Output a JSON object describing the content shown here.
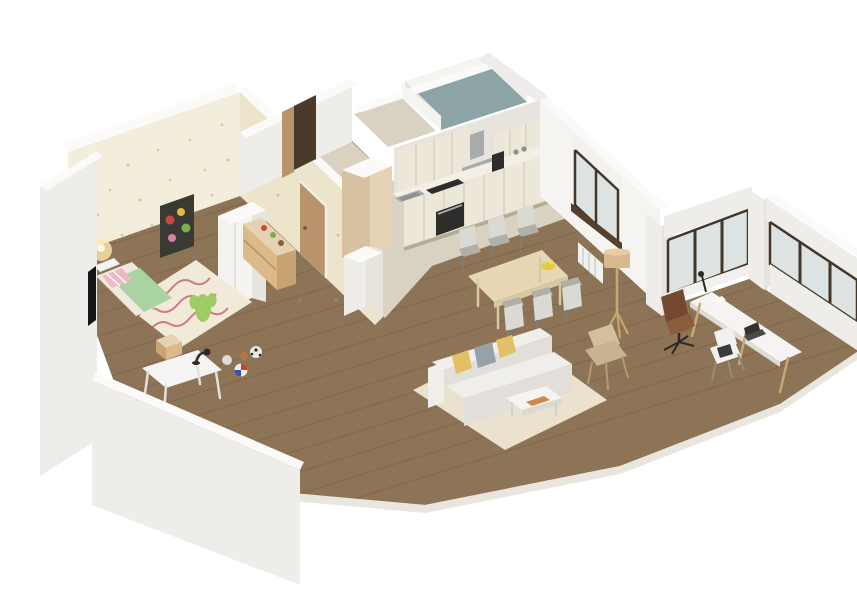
{
  "title": "isometric-3d-apartment-floor-plan-render",
  "view": {
    "type": "isometric-cutaway-render",
    "background": "#ffffff",
    "no_visible_text": true
  },
  "rooms": [
    {
      "id": "kids-bedroom",
      "floor": "wood",
      "walls": "patterned-wallpaper",
      "furniture": [
        "bed",
        "wavy-rug",
        "toy-cactus",
        "white-desk",
        "desk-lamp",
        "stool",
        "balls",
        "wardrobe",
        "dresser",
        "poster",
        "wall-lamp",
        "door"
      ]
    },
    {
      "id": "hallway",
      "floor": "tile",
      "furniture": [
        "back-door"
      ]
    },
    {
      "id": "bathroom",
      "floor": "teal"
    },
    {
      "id": "closet-nook",
      "floor": "tile"
    },
    {
      "id": "kitchen",
      "floor": "tile",
      "furniture": [
        "upper-cabinets",
        "range-hood",
        "cooktop",
        "oven",
        "sink",
        "coffee-maker",
        "tall-cabinet",
        "peninsula-pillar"
      ]
    },
    {
      "id": "dining-area",
      "floor": "wood",
      "furniture": [
        "dining-table",
        "six-chairs",
        "fruit-bowl",
        "window",
        "radiator"
      ]
    },
    {
      "id": "living-room",
      "floor": "wood",
      "furniture": [
        "sofa",
        "pillows",
        "coffee-table",
        "area-rug",
        "tripod-floor-lamp",
        "shell-chair"
      ]
    },
    {
      "id": "office-nook",
      "floor": "wood",
      "furniture": [
        "long-desk",
        "laptop",
        "desk-lamp",
        "leather-office-chair",
        "white-side-chair",
        "corner-windows"
      ]
    }
  ],
  "colors": {
    "bg": "#ffffff",
    "wood": "#8d7457",
    "tile": "#d9d1c2",
    "bath": "#8da4a6",
    "wallWhite": "#efedea",
    "wallLit": "#f5f4f1",
    "wallShade": "#e7e4de",
    "wallTop": "#fbfaf8",
    "wallpaper": "#f3eedb",
    "wallpaperEdge": "#ece5cc",
    "wallpaperDot": "#b3ab83",
    "posterBg": "#3a3a34",
    "doorWood": "#b9936b",
    "doorDark": "#4a3a2c",
    "wardrobe": "#f4f3f0",
    "wardrobeSide": "#e6e4df",
    "dresser": "#dcb988",
    "dresserSide": "#c9a371",
    "bedFrame": "#efe9dd",
    "bedGreen": "#a9d3a2",
    "bedPink": "#f0b7c4",
    "kidsRug": "#f2ead8",
    "rugLine": "#c2586b",
    "deskWhite": "#f5f4f2",
    "lampBlack": "#2b2a28",
    "cabinet": "#ece7d9",
    "cabinetShade": "#ddd6c4",
    "counter": "#f3efe4",
    "tallTan": "#d8c1a0",
    "tallTanLit": "#e5d2b4",
    "steel": "#a7abac",
    "applianceDark": "#2e2d2b",
    "table": "#e8d7b4",
    "tableLeg": "#d9c79f",
    "chairShell": "#b0b0a8",
    "chairLight": "#dadad5",
    "bowlYellow": "#e9c93f",
    "livingRug": "#eae2cf",
    "sofa": "#f0eeea",
    "sofaShade": "#e2dfda",
    "pillowYellow": "#e3bf66",
    "pillowGray": "#98a0a8",
    "shellChair": "#d3bf9e",
    "lampWoodShade": "#d8b98d",
    "legWood": "#c8a874",
    "glass": "#dde3e3",
    "frameDark": "#413629",
    "sillDark": "#54402c",
    "radiator": "#f2f1ee",
    "officeChair": "#8a5c3e",
    "officeChairDark": "#74492f",
    "eames": "#f2f1ef",
    "laptop": "#333230",
    "slabEdge": "#e9e6df",
    "ballRed": "#d33d2e",
    "ballBlue": "#2e55b0",
    "ballBrown": "#b5773f",
    "soccer": "#e8e8e6",
    "cactus": "#9ccc63",
    "glow": "#ffe6a8"
  }
}
